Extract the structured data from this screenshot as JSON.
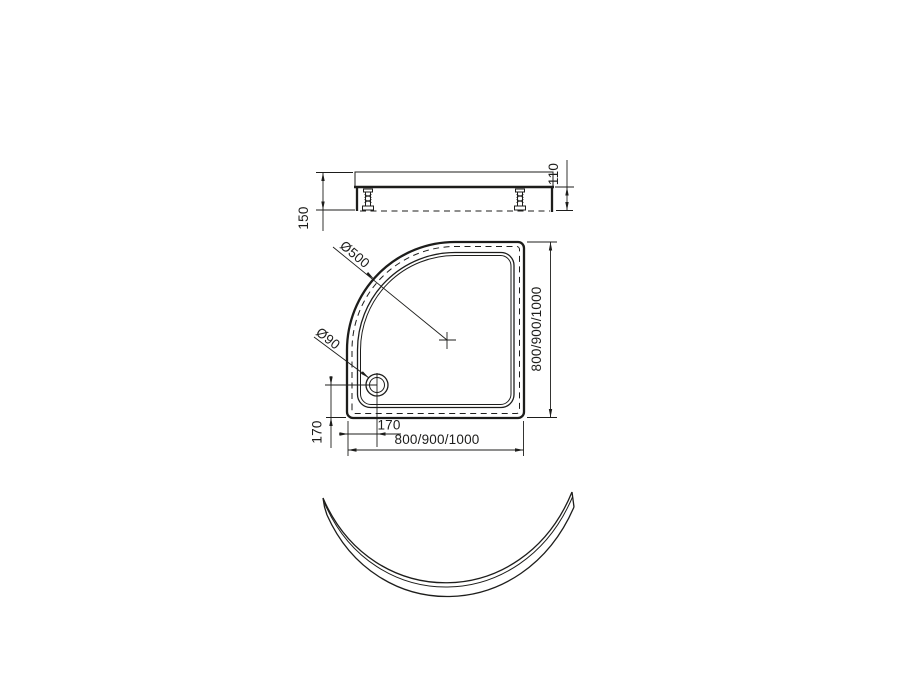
{
  "meta": {
    "background_color": "#ffffff",
    "line_color": "#1d1d1b",
    "drawing_type": "quadrant shower tray technical drawing"
  },
  "side_view": {
    "height_total": "150",
    "height_body": "110"
  },
  "plan_view": {
    "corner_diameter": "Ø500",
    "drain_diameter": "Ø90",
    "drain_offset_horizontal": "170",
    "drain_offset_vertical": "170",
    "overall_width": "800/900/1000",
    "overall_depth": "800/900/1000"
  }
}
